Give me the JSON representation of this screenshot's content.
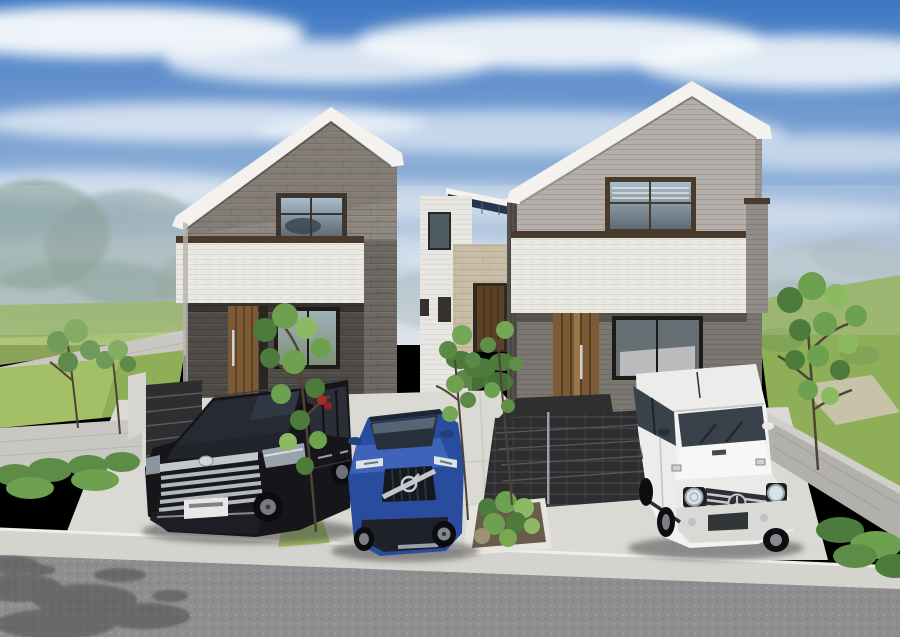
{
  "scene": {
    "title": "Photorealistic CG exterior rendering of two modern two-story houses with three parked cars",
    "setting": "Suburban street in daylight, blue sky with streaked clouds, misty trees and green lawns in the background, concrete block boundary walls",
    "objects": [
      {
        "name": "left-house",
        "description": "Front-gable house, dark grey stone-look upper facade, white textured balcony band with dark brown coping, dark stone ground floor, wood entrance door, dark-framed windows, steps at left"
      },
      {
        "name": "middle-house",
        "description": "Background house with white siding, solar panels on low roof, beige stone entrance column and wood door"
      },
      {
        "name": "right-house",
        "description": "Asymmetric front-gable house, light grey horizontal siding upper floor, white textured balcony band with dark brown coping, dark grey ground floor, wood entrance door, wide dark tiled entrance steps"
      },
      {
        "name": "black-minivan",
        "description": "Black luxury minivan with large multi-bar chrome grille, white licence plate, parked facing the street"
      },
      {
        "name": "blue-suv",
        "description": "Blue SUV with black grille crossed by a diagonal chrome bar and round emblem, thin LED headlights"
      },
      {
        "name": "white-suv",
        "description": "White boxy 4x4 off-roader with round headlights, three-pointed star grille emblem, dark fender trim"
      },
      {
        "name": "garden",
        "description": "Slender deciduous trees, low shrubs in planting beds, bright lawn patches, one small red shrub"
      },
      {
        "name": "street",
        "description": "Grey speckled asphalt road with light concrete curb and sidewalk, dappled tree shadow at lower left"
      }
    ]
  },
  "colors": {
    "sky_top": "#3e77c2",
    "sky_mid": "#8badd7",
    "sky_horizon": "#e0e5e9",
    "cloud": "#f7fafc",
    "haze_tree": "#7d9590",
    "lawn": "#8fae58",
    "lawn_bright": "#a3c067",
    "gravel": "#cdc5b2",
    "block_wall": "#c9c7c1",
    "block_wall_shade": "#b2b0aa",
    "stone_upper": "#8f8881",
    "stone_lower": "#4f4b47",
    "band_white": "#ebe9e4",
    "trim_brown": "#4a3a2c",
    "siding_upper": "#b4afa9",
    "siding_lower": "#7a7670",
    "fascia_white": "#f4f2ee",
    "door_wood": "#7c5a35",
    "door_wood_dark": "#5d4124",
    "glass_dark": "#333d46",
    "glass_sky": "#9db3c2",
    "steps_dark": "#2e2e31",
    "concrete": "#dbd9d4",
    "curb": "#d5d3cd",
    "road": "#8e8e90",
    "van_black": "#16161a",
    "suv_blue": "#2a4c9e",
    "suv_blue_light": "#4168bd",
    "white_suv": "#f2f2f0",
    "chrome": "#c3c7cb",
    "foliage_dark": "#4d7b3b",
    "foliage_mid": "#6da04f",
    "foliage_light": "#8cba62",
    "trunk": "#4e4336",
    "shadow": "#3c3d41",
    "solar_panel": "#26354e",
    "stone_beige": "#c8bda6",
    "mid_house_white": "#e7e6e2",
    "red_shrub": "#a03028"
  }
}
